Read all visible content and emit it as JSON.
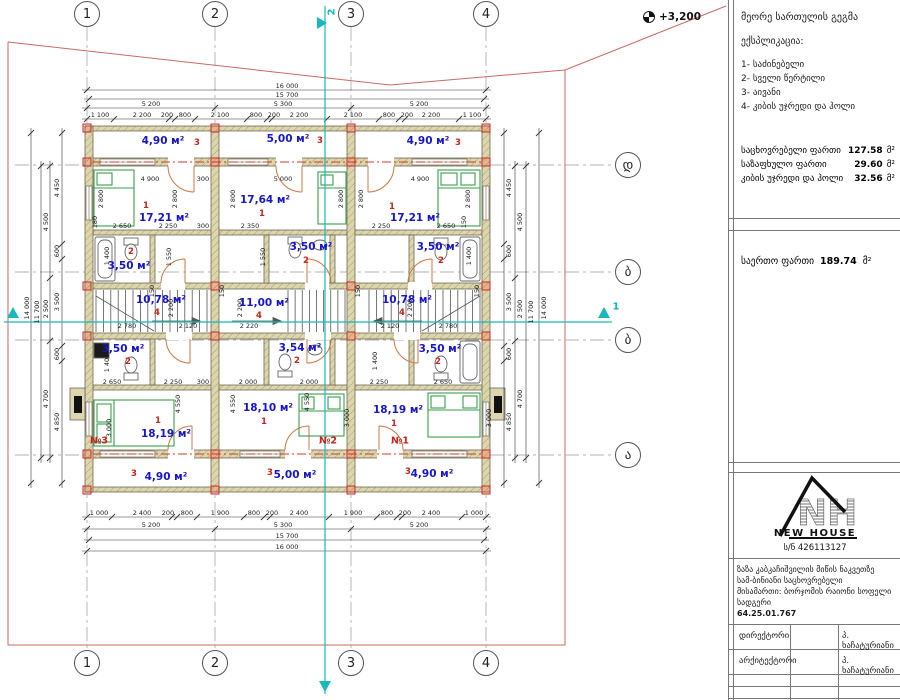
{
  "elevation": "+3,200",
  "panel": {
    "title": "მეორე სართულის გეგმა",
    "explication_heading": "ექსპლიკაცია:",
    "items": [
      "1- საძინებელი",
      "2- სველი წერტილი",
      "3- აივანი",
      "4- კიბის უჯრედი და ჰოლი"
    ],
    "areas": [
      {
        "label": "საცხოვრებელი ფართი",
        "value": "127.58",
        "unit": "მ²"
      },
      {
        "label": "საზაფხულო ფართი",
        "value": "29.60",
        "unit": "მ²"
      },
      {
        "label": "კიბის უჯრედი და ჰოლი",
        "value": "32.56",
        "unit": "მ²"
      }
    ],
    "total": {
      "label": "საერთო ფართი",
      "value": "189.74",
      "unit": "მ²"
    },
    "logo": {
      "initials": "NH",
      "name": "NEW HOUSE",
      "reg": "ს/ნ 426113127"
    },
    "project": [
      "ზაზა კაბკაჩიშვილის მიწის ნაკვეთზე",
      "სამ-ბინიანი საცხოვრებელი",
      "მისამართი: ბორჯომის რაიონი სოფელი",
      "სადგერი",
      "64.25.01.767"
    ],
    "table": [
      {
        "role": "დირექტორი",
        "name": "პ. ხაჩატურიანი"
      },
      {
        "role": "არქიტექტორი",
        "name": "პ. ხაჩატურიანი"
      },
      {
        "role": "",
        "name": ""
      },
      {
        "role": "",
        "name": ""
      }
    ]
  },
  "drawing": {
    "axes": {
      "cols": [
        {
          "label": "1",
          "x": 87
        },
        {
          "label": "2",
          "x": 215
        },
        {
          "label": "3",
          "x": 351
        },
        {
          "label": "4",
          "x": 486
        }
      ],
      "rows": [
        {
          "label": "დ",
          "y": 165
        },
        {
          "label": "ბ",
          "y": 272
        },
        {
          "label": "ბ",
          "y": 340
        },
        {
          "label": "ა",
          "y": 455
        }
      ],
      "top_y": 14,
      "bottom_y": 663,
      "right_x": 628
    },
    "sections": [
      {
        "t": "2",
        "x": 332,
        "y": 12,
        "r": 1
      },
      {
        "t": "1",
        "x": 616,
        "y": 307,
        "r": 0
      }
    ],
    "chains": [
      {
        "o": "h",
        "pos": 90,
        "ticks": [
          87,
          486
        ]
      },
      {
        "o": "h",
        "pos": 99,
        "ticks": [
          89,
          484
        ]
      },
      {
        "o": "h",
        "pos": 108,
        "ticks": [
          87,
          215,
          351,
          486
        ]
      },
      {
        "o": "h",
        "pos": 119,
        "ticks": [
          87,
          114,
          169,
          175,
          195,
          247,
          267,
          272,
          327,
          379,
          399,
          405,
          459,
          486
        ]
      },
      {
        "o": "h",
        "pos": 517,
        "ticks": [
          87,
          112,
          172,
          177,
          197,
          244,
          264,
          270,
          329,
          377,
          397,
          402,
          462,
          486
        ]
      },
      {
        "o": "h",
        "pos": 529,
        "ticks": [
          87,
          215,
          351,
          486
        ]
      },
      {
        "o": "h",
        "pos": 540,
        "ticks": [
          89,
          484
        ]
      },
      {
        "o": "h",
        "pos": 551,
        "ticks": [
          87,
          486
        ]
      },
      {
        "o": "v",
        "pos": 62,
        "ticks": [
          133,
          244,
          259,
          346,
          361,
          483
        ]
      },
      {
        "o": "v",
        "pos": 50,
        "ticks": [
          166,
          278,
          341,
          458
        ]
      },
      {
        "o": "v",
        "pos": 41,
        "ticks": [
          166,
          458
        ]
      },
      {
        "o": "v",
        "pos": 31,
        "ticks": [
          133,
          483
        ]
      },
      {
        "o": "v",
        "pos": 504,
        "ticks": [
          133,
          244,
          259,
          346,
          361,
          483
        ]
      },
      {
        "o": "v",
        "pos": 515,
        "ticks": [
          166,
          278,
          341,
          458
        ]
      },
      {
        "o": "v",
        "pos": 526,
        "ticks": [
          166,
          458
        ]
      },
      {
        "o": "v",
        "pos": 539,
        "ticks": [
          133,
          483
        ]
      }
    ],
    "dims": [
      {
        "t": "16 000",
        "x": 287,
        "y": 86
      },
      {
        "t": "15 700",
        "x": 287,
        "y": 95
      },
      {
        "t": "5 200",
        "x": 151,
        "y": 104
      },
      {
        "t": "5 300",
        "x": 283,
        "y": 104
      },
      {
        "t": "5 200",
        "x": 419,
        "y": 104
      },
      {
        "t": "1 100",
        "x": 100,
        "y": 115
      },
      {
        "t": "2 200",
        "x": 142,
        "y": 115
      },
      {
        "t": "200",
        "x": 167,
        "y": 115
      },
      {
        "t": "800",
        "x": 185,
        "y": 115
      },
      {
        "t": "2 100",
        "x": 220,
        "y": 115
      },
      {
        "t": "800",
        "x": 256,
        "y": 115
      },
      {
        "t": "200",
        "x": 274,
        "y": 115
      },
      {
        "t": "2 200",
        "x": 299,
        "y": 115
      },
      {
        "t": "2 100",
        "x": 353,
        "y": 115
      },
      {
        "t": "800",
        "x": 389,
        "y": 115
      },
      {
        "t": "200",
        "x": 407,
        "y": 115
      },
      {
        "t": "2 200",
        "x": 431,
        "y": 115
      },
      {
        "t": "1 100",
        "x": 472,
        "y": 115
      },
      {
        "t": "1 000",
        "x": 99,
        "y": 513
      },
      {
        "t": "2 400",
        "x": 142,
        "y": 513
      },
      {
        "t": "200",
        "x": 168,
        "y": 513
      },
      {
        "t": "800",
        "x": 187,
        "y": 513
      },
      {
        "t": "1 900",
        "x": 220,
        "y": 513
      },
      {
        "t": "800",
        "x": 254,
        "y": 513
      },
      {
        "t": "200",
        "x": 272,
        "y": 513
      },
      {
        "t": "2 400",
        "x": 299,
        "y": 513
      },
      {
        "t": "1 900",
        "x": 353,
        "y": 513
      },
      {
        "t": "800",
        "x": 387,
        "y": 513
      },
      {
        "t": "200",
        "x": 405,
        "y": 513
      },
      {
        "t": "2 400",
        "x": 431,
        "y": 513
      },
      {
        "t": "1 000",
        "x": 474,
        "y": 513
      },
      {
        "t": "5 200",
        "x": 151,
        "y": 525
      },
      {
        "t": "5 300",
        "x": 283,
        "y": 525
      },
      {
        "t": "5 200",
        "x": 419,
        "y": 525
      },
      {
        "t": "15 700",
        "x": 287,
        "y": 536
      },
      {
        "t": "16 000",
        "x": 287,
        "y": 547
      },
      {
        "t": "4 450",
        "x": 57,
        "y": 188,
        "r": 1
      },
      {
        "t": "600",
        "x": 57,
        "y": 251,
        "r": 1
      },
      {
        "t": "3 500",
        "x": 57,
        "y": 302,
        "r": 1
      },
      {
        "t": "600",
        "x": 57,
        "y": 354,
        "r": 1
      },
      {
        "t": "4 850",
        "x": 57,
        "y": 422,
        "r": 1
      },
      {
        "t": "4 500",
        "x": 46,
        "y": 222,
        "r": 1
      },
      {
        "t": "2 500",
        "x": 46,
        "y": 309,
        "r": 1
      },
      {
        "t": "4 700",
        "x": 46,
        "y": 399,
        "r": 1
      },
      {
        "t": "11 700",
        "x": 37,
        "y": 312,
        "r": 1
      },
      {
        "t": "14 000",
        "x": 27,
        "y": 308,
        "r": 1
      },
      {
        "t": "4 450",
        "x": 509,
        "y": 188,
        "r": 1
      },
      {
        "t": "600",
        "x": 509,
        "y": 251,
        "r": 1
      },
      {
        "t": "3 500",
        "x": 509,
        "y": 302,
        "r": 1
      },
      {
        "t": "600",
        "x": 509,
        "y": 354,
        "r": 1
      },
      {
        "t": "4 850",
        "x": 509,
        "y": 422,
        "r": 1
      },
      {
        "t": "4 500",
        "x": 520,
        "y": 222,
        "r": 1
      },
      {
        "t": "2 500",
        "x": 520,
        "y": 309,
        "r": 1
      },
      {
        "t": "4 700",
        "x": 520,
        "y": 399,
        "r": 1
      },
      {
        "t": "11 700",
        "x": 531,
        "y": 312,
        "r": 1
      },
      {
        "t": "14 000",
        "x": 544,
        "y": 308,
        "r": 1
      },
      {
        "t": "4 900",
        "x": 150,
        "y": 179
      },
      {
        "t": "300",
        "x": 203,
        "y": 179
      },
      {
        "t": "5 000",
        "x": 283,
        "y": 179
      },
      {
        "t": "4 900",
        "x": 420,
        "y": 179
      },
      {
        "t": "2 800",
        "x": 101,
        "y": 199,
        "r": 1
      },
      {
        "t": "2 800",
        "x": 175,
        "y": 199,
        "r": 1
      },
      {
        "t": "2 800",
        "x": 233,
        "y": 199,
        "r": 1
      },
      {
        "t": "2 800",
        "x": 341,
        "y": 199,
        "r": 1
      },
      {
        "t": "2 800",
        "x": 361,
        "y": 199,
        "r": 1
      },
      {
        "t": "2 800",
        "x": 468,
        "y": 199,
        "r": 1
      },
      {
        "t": "2 650",
        "x": 122,
        "y": 226
      },
      {
        "t": "2 250",
        "x": 168,
        "y": 226
      },
      {
        "t": "300",
        "x": 203,
        "y": 226
      },
      {
        "t": "180",
        "x": 95,
        "y": 222,
        "r": 1
      },
      {
        "t": "2 350",
        "x": 250,
        "y": 226
      },
      {
        "t": "2 250",
        "x": 381,
        "y": 226
      },
      {
        "t": "2 650",
        "x": 446,
        "y": 226
      },
      {
        "t": "150",
        "x": 464,
        "y": 222,
        "r": 1
      },
      {
        "t": "1 400",
        "x": 107,
        "y": 256,
        "r": 1
      },
      {
        "t": "1 550",
        "x": 169,
        "y": 257,
        "r": 1
      },
      {
        "t": "1 550",
        "x": 263,
        "y": 257,
        "r": 1
      },
      {
        "t": "1 400",
        "x": 469,
        "y": 256,
        "r": 1
      },
      {
        "t": "150",
        "x": 152,
        "y": 291,
        "r": 1
      },
      {
        "t": "150",
        "x": 222,
        "y": 291,
        "r": 1
      },
      {
        "t": "150",
        "x": 358,
        "y": 291,
        "r": 1
      },
      {
        "t": "150",
        "x": 477,
        "y": 291,
        "r": 1
      },
      {
        "t": "2 780",
        "x": 127,
        "y": 326
      },
      {
        "t": "2 120",
        "x": 188,
        "y": 326
      },
      {
        "t": "2 220",
        "x": 249,
        "y": 326
      },
      {
        "t": "2 120",
        "x": 390,
        "y": 326
      },
      {
        "t": "2 780",
        "x": 448,
        "y": 326
      },
      {
        "t": "2 200",
        "x": 171,
        "y": 308,
        "r": 1
      },
      {
        "t": "2 200",
        "x": 240,
        "y": 308,
        "r": 1
      },
      {
        "t": "2 200",
        "x": 410,
        "y": 308,
        "r": 1
      },
      {
        "t": "1 400",
        "x": 107,
        "y": 363,
        "r": 1
      },
      {
        "t": "1 400",
        "x": 375,
        "y": 361,
        "r": 1
      },
      {
        "t": "2 650",
        "x": 112,
        "y": 382
      },
      {
        "t": "2 250",
        "x": 173,
        "y": 382
      },
      {
        "t": "300",
        "x": 203,
        "y": 382
      },
      {
        "t": "2 000",
        "x": 248,
        "y": 382
      },
      {
        "t": "2 000",
        "x": 309,
        "y": 382
      },
      {
        "t": "2 250",
        "x": 379,
        "y": 382
      },
      {
        "t": "2 650",
        "x": 443,
        "y": 382
      },
      {
        "t": "4 550",
        "x": 178,
        "y": 404,
        "r": 1
      },
      {
        "t": "4 550",
        "x": 233,
        "y": 404,
        "r": 1
      },
      {
        "t": "4 550",
        "x": 307,
        "y": 402,
        "r": 1
      },
      {
        "t": "3 000",
        "x": 109,
        "y": 428,
        "r": 1
      },
      {
        "t": "3 000",
        "x": 347,
        "y": 418,
        "r": 1
      },
      {
        "t": "3 000",
        "x": 489,
        "y": 418,
        "r": 1
      }
    ],
    "rooms": [
      {
        "a": "4,90 м²",
        "x": 163,
        "y": 141,
        "n": "3",
        "nx": 197,
        "ny": 143
      },
      {
        "a": "5,00 м²",
        "x": 288,
        "y": 139,
        "n": "3",
        "nx": 320,
        "ny": 141
      },
      {
        "a": "4,90 м²",
        "x": 428,
        "y": 141,
        "n": "3",
        "nx": 458,
        "ny": 143
      },
      {
        "a": "17,21 м²",
        "x": 164,
        "y": 218,
        "n": "1",
        "nx": 146,
        "ny": 206
      },
      {
        "a": "17,64 м²",
        "x": 265,
        "y": 200,
        "n": "1",
        "nx": 262,
        "ny": 214
      },
      {
        "a": "17,21 м²",
        "x": 415,
        "y": 218,
        "n": "1",
        "nx": 392,
        "ny": 207
      },
      {
        "a": "3,50 м²",
        "x": 129,
        "y": 266,
        "n": "2",
        "nx": 131,
        "ny": 252
      },
      {
        "a": "3,50 м²",
        "x": 311,
        "y": 247,
        "n": "2",
        "nx": 306,
        "ny": 261
      },
      {
        "a": "3,50 м²",
        "x": 438,
        "y": 247,
        "n": "2",
        "nx": 441,
        "ny": 261
      },
      {
        "a": "10,78 м²",
        "x": 161,
        "y": 300,
        "n": "4",
        "nx": 157,
        "ny": 313
      },
      {
        "a": "11,00 м²",
        "x": 264,
        "y": 303,
        "n": "4",
        "nx": 259,
        "ny": 316
      },
      {
        "a": "10,78 м²",
        "x": 407,
        "y": 300,
        "n": "4",
        "nx": 402,
        "ny": 313
      },
      {
        "a": "3,50 м²",
        "x": 123,
        "y": 349,
        "n": "2",
        "nx": 128,
        "ny": 362
      },
      {
        "a": "3,54 м²",
        "x": 300,
        "y": 348,
        "n": "2",
        "nx": 297,
        "ny": 361
      },
      {
        "a": "3,50 м²",
        "x": 440,
        "y": 349,
        "n": "2",
        "nx": 438,
        "ny": 362
      },
      {
        "a": "18,19 м²",
        "x": 166,
        "y": 434,
        "n": "1",
        "nx": 158,
        "ny": 421
      },
      {
        "a": "18,10 м²",
        "x": 268,
        "y": 408,
        "n": "1",
        "nx": 264,
        "ny": 422
      },
      {
        "a": "18,19 м²",
        "x": 398,
        "y": 410,
        "n": "1",
        "nx": 394,
        "ny": 424
      },
      {
        "a": "4,90 м²",
        "x": 166,
        "y": 477,
        "n": "3",
        "nx": 134,
        "ny": 474
      },
      {
        "a": "5,00 м²",
        "x": 295,
        "y": 475,
        "n": "3",
        "nx": 270,
        "ny": 473
      },
      {
        "a": "4,90 м²",
        "x": 432,
        "y": 474,
        "n": "3",
        "nx": 408,
        "ny": 472
      }
    ],
    "units": [
      {
        "t": "№3",
        "x": 99,
        "y": 441
      },
      {
        "t": "№2",
        "x": 328,
        "y": 441
      },
      {
        "t": "№1",
        "x": 400,
        "y": 441
      }
    ],
    "markers": [
      [
        87,
        128
      ],
      [
        215,
        128
      ],
      [
        351,
        128
      ],
      [
        486,
        128
      ],
      [
        87,
        162
      ],
      [
        215,
        162
      ],
      [
        351,
        162
      ],
      [
        486,
        162
      ],
      [
        87,
        286
      ],
      [
        215,
        286
      ],
      [
        351,
        286
      ],
      [
        486,
        286
      ],
      [
        87,
        336
      ],
      [
        215,
        336
      ],
      [
        351,
        336
      ],
      [
        486,
        336
      ],
      [
        87,
        454
      ],
      [
        215,
        454
      ],
      [
        351,
        454
      ],
      [
        486,
        454
      ],
      [
        87,
        490
      ],
      [
        215,
        490
      ],
      [
        351,
        490
      ],
      [
        486,
        490
      ]
    ]
  }
}
